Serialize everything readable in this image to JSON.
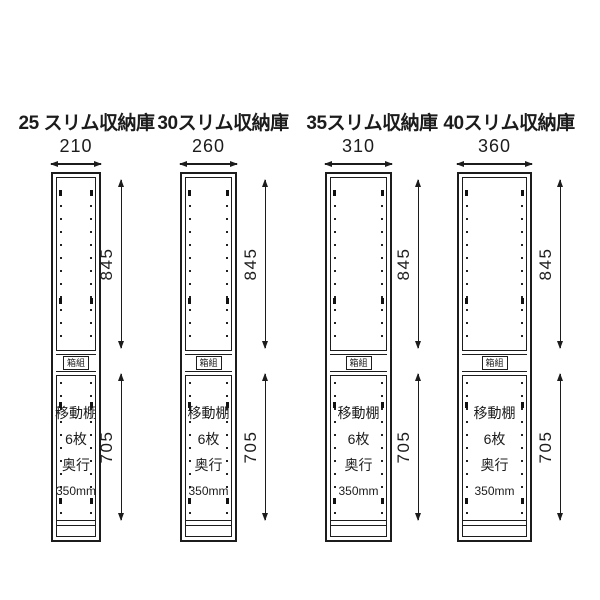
{
  "diagram": {
    "background": "#ffffff",
    "line_color": "#1c1c1c",
    "cabinets": [
      {
        "title": "25 スリム収納庫",
        "width": "210",
        "upper_height": "845",
        "lower_height": "705",
        "center_label": "箱組",
        "interior_lines": [
          "移動棚",
          "6枚",
          "奥行",
          "350mm"
        ]
      },
      {
        "title": "30スリム収納庫",
        "width": "260",
        "upper_height": "845",
        "lower_height": "705",
        "center_label": "箱組",
        "interior_lines": [
          "移動棚",
          "6枚",
          "奥行",
          "350mm"
        ]
      },
      {
        "title": "35スリム収納庫",
        "width": "310",
        "upper_height": "845",
        "lower_height": "705",
        "center_label": "箱組",
        "interior_lines": [
          "移動棚",
          "6枚",
          "奥行",
          "350mm"
        ]
      },
      {
        "title": "40スリム収納庫",
        "width": "360",
        "upper_height": "845",
        "lower_height": "705",
        "center_label": "箱組",
        "interior_lines": [
          "移動棚",
          "6枚",
          "奥行",
          "350mm"
        ]
      }
    ]
  }
}
